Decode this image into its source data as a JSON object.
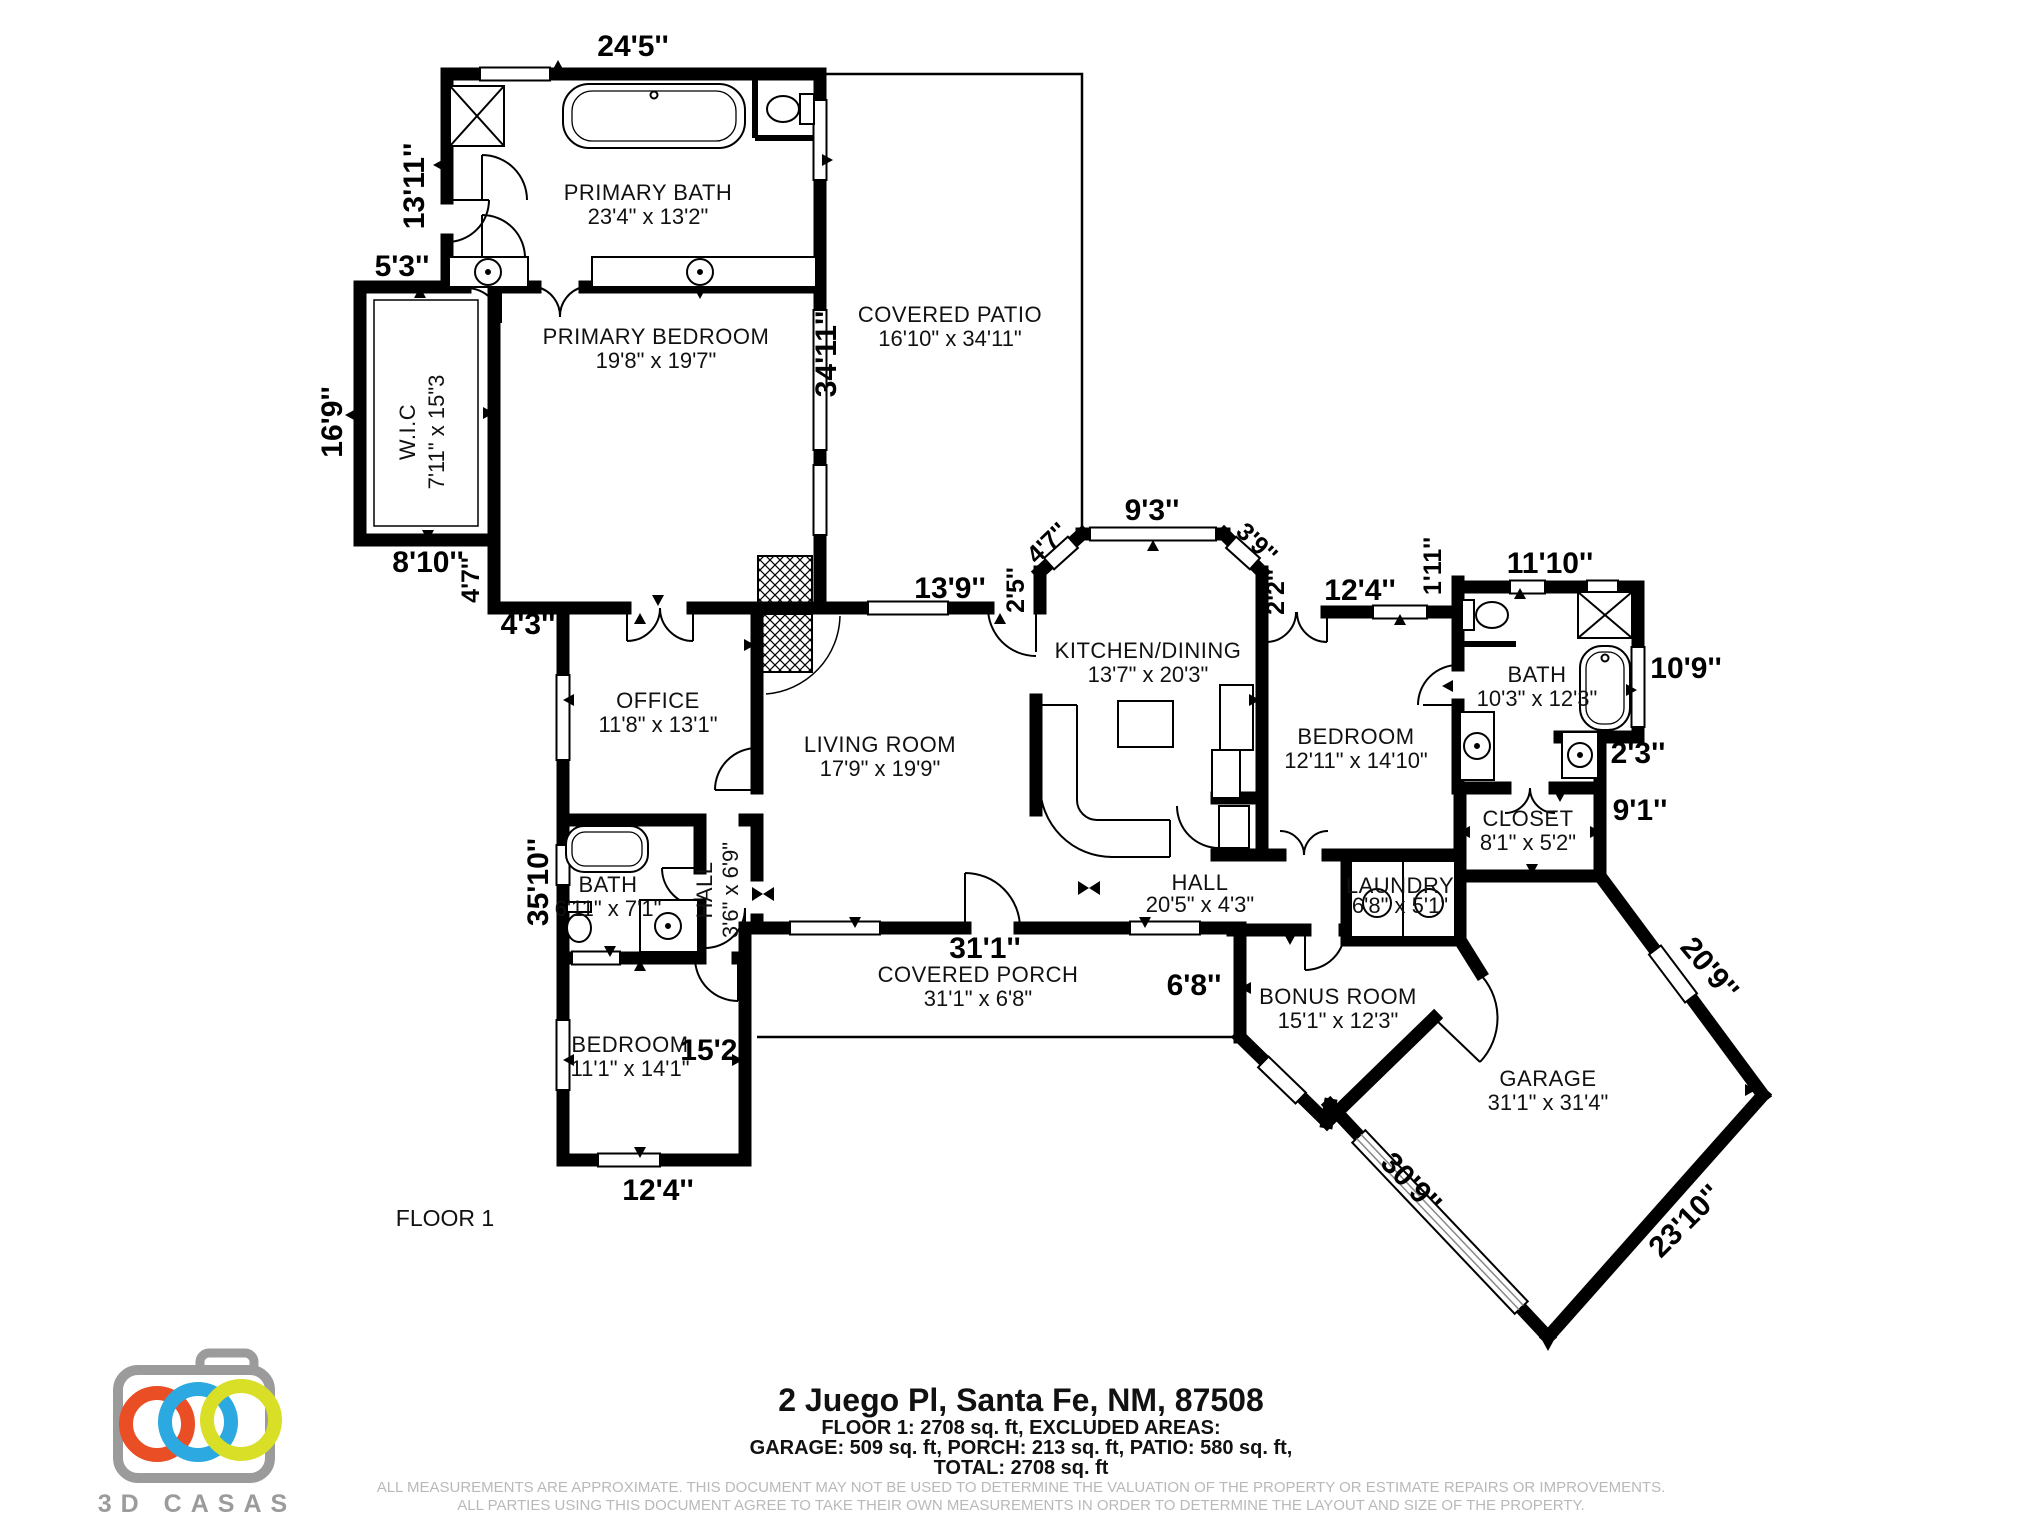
{
  "floor_label": "FLOOR 1",
  "rooms": [
    {
      "name": "PRIMARY BATH",
      "dims": "23'4\" x 13'2\""
    },
    {
      "name": "W.I.C",
      "dims": "7'11\" x 15\"3"
    },
    {
      "name": "PRIMARY BEDROOM",
      "dims": "19'8\" x 19'7\""
    },
    {
      "name": "COVERED PATIO",
      "dims": "16'10\" x 34'11\""
    },
    {
      "name": "OFFICE",
      "dims": "11'8\" x 13'1\""
    },
    {
      "name": "LIVING ROOM",
      "dims": "17'9\" x 19'9\""
    },
    {
      "name": "KITCHEN/DINING",
      "dims": "13'7\" x 20'3\""
    },
    {
      "name": "BEDROOM",
      "dims": "12'11\" x 14'10\""
    },
    {
      "name": "BATH",
      "dims": "10'3\" x 12'3\""
    },
    {
      "name": "CLOSET",
      "dims": "8'1\" x 5'2\""
    },
    {
      "name": "BATH",
      "dims": "6'11\" x 7'1\""
    },
    {
      "name": "HALL",
      "dims": "3'6\" x 6'9\""
    },
    {
      "name": "HALL",
      "dims": "20'5\" x 4'3\""
    },
    {
      "name": "LAUNDRY",
      "dims": "6'8\" x 5'1\""
    },
    {
      "name": "COVERED PORCH",
      "dims": "31'1\" x 6'8\""
    },
    {
      "name": "BEDROOM",
      "dims": "11'1\" x 14'1\""
    },
    {
      "name": "BONUS ROOM",
      "dims": "15'1\" x 12'3\""
    },
    {
      "name": "GARAGE",
      "dims": "31'1\" x 31'4\""
    }
  ],
  "dims": [
    "24'5''",
    "13'11''",
    "5'3''",
    "16'9''",
    "8'10''",
    "4'7''",
    "4'3''",
    "34'11''",
    "13'9''",
    "2'5''",
    "4'7''",
    "9'3''",
    "3'9''",
    "2'2''",
    "12'4''",
    "1'11''",
    "11'10''",
    "10'9''",
    "2'3''",
    "9'1''",
    "35'10''",
    "31'1''",
    "6'8''",
    "15'2''",
    "12'4''",
    "20'9''",
    "23'10''",
    "30'9''"
  ],
  "footer": {
    "address": "2 Juego Pl, Santa Fe, NM, 87508",
    "line1": "FLOOR 1: 2708 sq. ft, EXCLUDED AREAS:",
    "line2": "GARAGE: 509 sq. ft, PORCH: 213 sq. ft, PATIO: 580 sq. ft,",
    "line3": "TOTAL: 2708 sq. ft",
    "disclaimer1": "ALL MEASUREMENTS ARE APPROXIMATE. THIS DOCUMENT MAY NOT BE USED TO DETERMINE THE VALUATION OF THE PROPERTY OR ESTIMATE REPAIRS OR IMPROVEMENTS.",
    "disclaimer2": "ALL PARTIES USING THIS DOCUMENT AGREE TO TAKE THEIR OWN MEASUREMENTS IN ORDER TO DETERMINE THE LAYOUT AND SIZE OF THE PROPERTY."
  },
  "logo": {
    "brand": "3D CASAS",
    "colors": {
      "ring_orange": "#E94E24",
      "ring_blue": "#2BA9E0",
      "ring_yellow": "#D9DE26",
      "camera_gray": "#9B9B9B",
      "wall_black": "#000000",
      "disclaimer_gray": "#B9B9B9"
    }
  }
}
